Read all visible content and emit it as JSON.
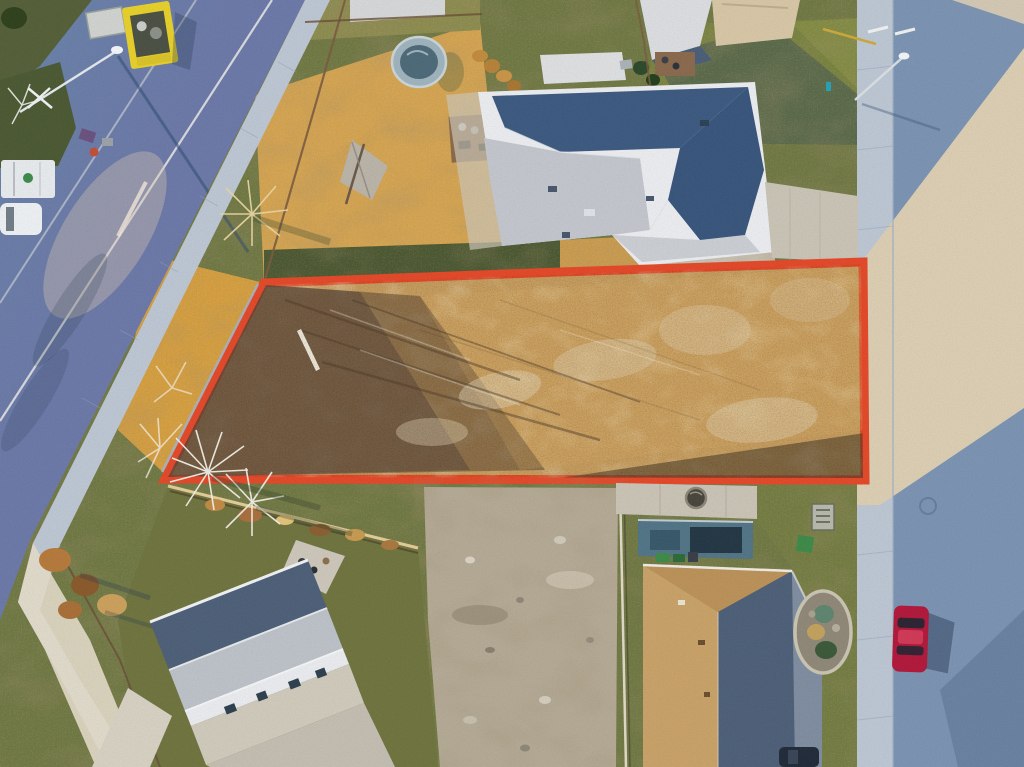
{
  "image": {
    "type": "aerial-drone-photograph",
    "subject": "vacant residential building lot highlighted with a red-orange boundary outline",
    "setting": "suburban street corner at golden hour with long shadows",
    "visible_text": []
  },
  "annotation": {
    "kind": "property-boundary-outline",
    "shape": "quadrilateral",
    "color": "#e2492a",
    "corners": [
      [
        264,
        283
      ],
      [
        863,
        262
      ],
      [
        865,
        480
      ],
      [
        165,
        479
      ]
    ]
  },
  "colors": {
    "grass_base": "#6f7743",
    "grass_dark": "#4c5832",
    "grass_gold": "#d2a250",
    "road_shadow": "#6a87a8",
    "road_right_shadow": "#7b93b2",
    "road_sunlit": "#dbcdb2",
    "sidewalk_shadow": "#bcc6d2",
    "sidewalk_sunlit": "#e5dccb",
    "lot_fill": "#c89e60",
    "lot_dark": "#5f4a36",
    "lot_pale": "#e2d4b6",
    "lot_outline": "#e2492a",
    "roof_light": "#c2c6cc",
    "roof_slate": "#3e5a80",
    "roof_tan": "#c7a168",
    "roof_slate2": "#4e6078",
    "wall_white": "#e9ebee",
    "wall_teal": "#527587",
    "concrete": "#c9c3b6",
    "gravel": "#b3a995",
    "truck_yellow": "#e5cf2c",
    "car_red": "#b11a3c",
    "bin_green": "#3e8a4a",
    "tree_frost": "#f2efe7",
    "foliage_orange": "#b5793c",
    "shadow_blue": "#2c4058"
  },
  "scene": {
    "objects": [
      {
        "name": "highlighted-vacant-lot",
        "description": "long quadrilateral dirt lot with dry golden grass, dark scrub patches and tree-branch shadows, outlined in thick red-orange"
      },
      {
        "name": "main-road-upper-left",
        "description": "shadowed asphalt road running diagonally with white lane lines and a streetlight shadow"
      },
      {
        "name": "yellow-flatbed-truck",
        "description": "yellow service truck parked on the corner median"
      },
      {
        "name": "white-truck-and-van",
        "description": "white utility vehicles parked on the side street at the left edge"
      },
      {
        "name": "street-light-upper-left",
        "description": "streetlight arm over the road casting a long shadow"
      },
      {
        "name": "house-top-center",
        "description": "large grey hip-roof house with sunlit and shadowed roof planes"
      },
      {
        "name": "round-pool",
        "description": "small round above-ground pool in golden backyard"
      },
      {
        "name": "tarp-shelter",
        "description": "grey tarp structure in backyard"
      },
      {
        "name": "right-street",
        "description": "vertical street on the right, sunlit beige band between long house shadows"
      },
      {
        "name": "red-car",
        "description": "red hatchback parked along the right street"
      },
      {
        "name": "dark-car",
        "description": "dark car at the bottom edge of the right street"
      },
      {
        "name": "house-bottom-left",
        "description": "grey-roofed house with white wall and windows, partly in shadow"
      },
      {
        "name": "house-bottom-center",
        "description": "new tan-roofed house with concrete pad and hot-tub circle behind the lot"
      },
      {
        "name": "gravel-lot",
        "description": "disturbed gravel/dirt area below the highlighted lot"
      },
      {
        "name": "garden-bed",
        "description": "oval rock-edged garden bed with shrubs on the right lawn"
      },
      {
        "name": "utility-box",
        "description": "small grey utility pad on the right lawn"
      },
      {
        "name": "frost-trees",
        "description": "bare frosted white trees at the lot's left corner"
      },
      {
        "name": "autumn-trees",
        "description": "orange-brown autumn trees near the lower-left sidewalk"
      }
    ]
  }
}
